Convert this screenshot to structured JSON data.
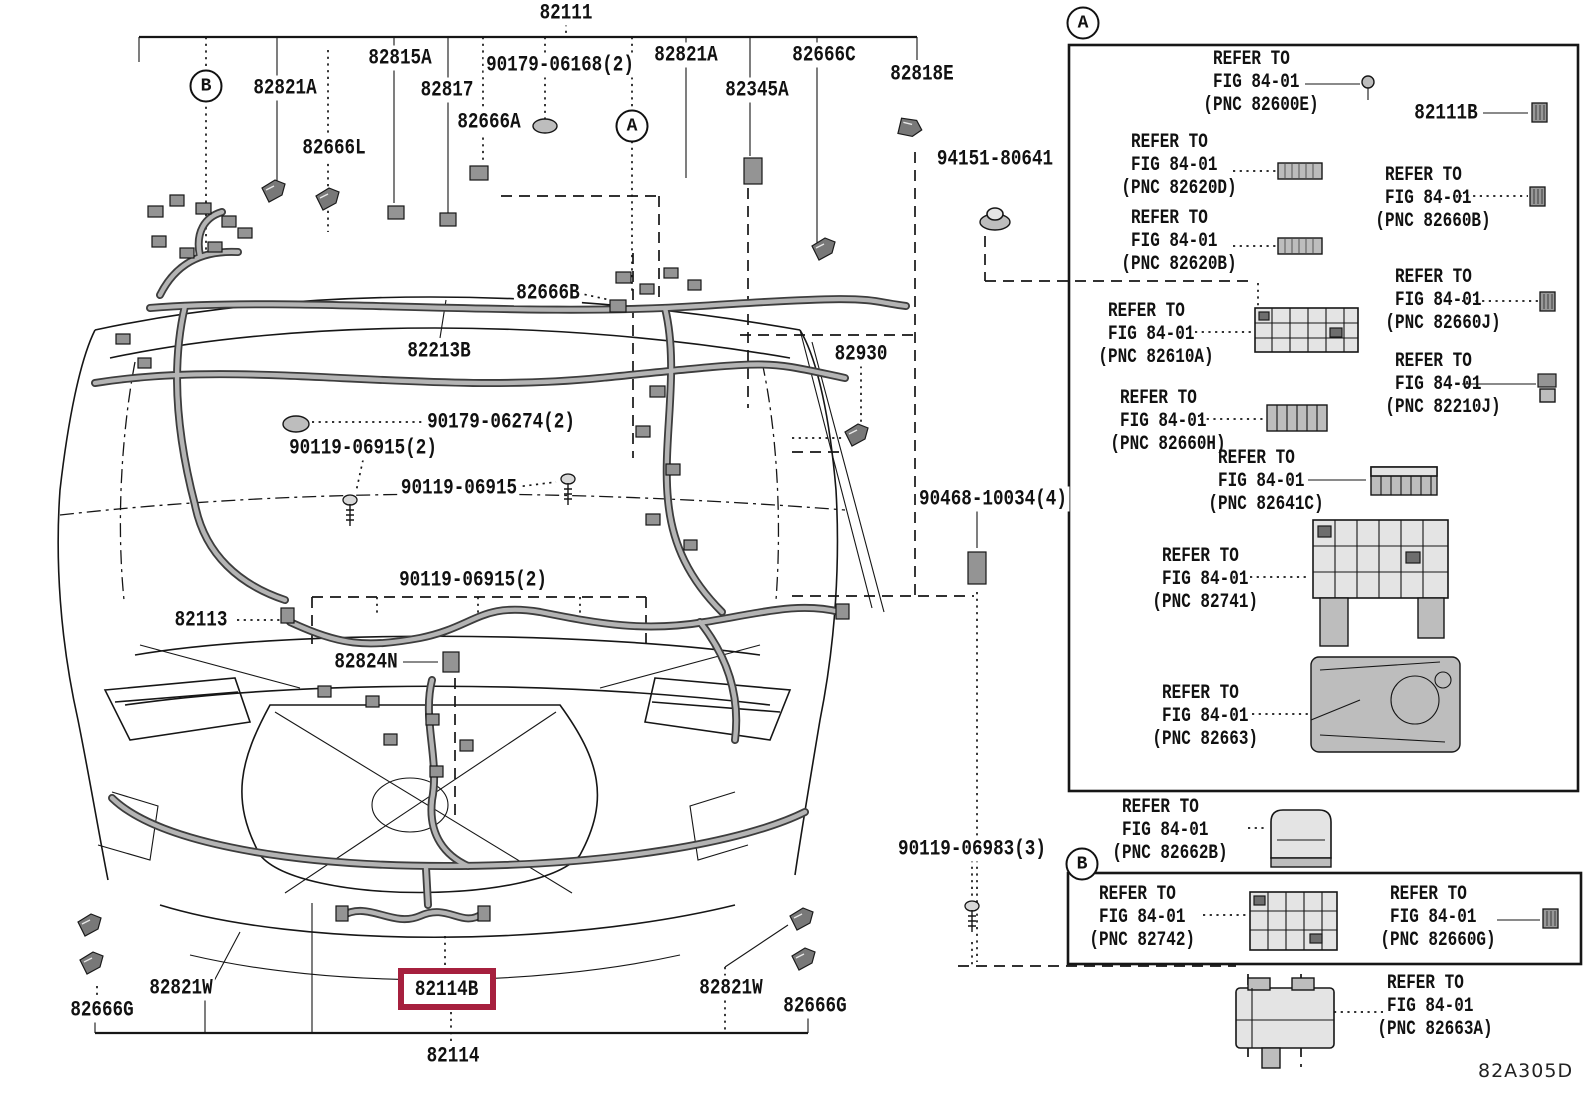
{
  "diagram_code": "82A305D",
  "highlight_color": "#a6203e",
  "markers": {
    "top_b": "B",
    "top_a": "A",
    "panel_a": "A",
    "panel_b": "B"
  },
  "labels": {
    "p82111": "82111",
    "p82821a_l": "82821A",
    "p82815a": "82815A",
    "p82817": "82817",
    "p90179_06168": "90179-06168(2)",
    "p82666a": "82666A",
    "p82666l": "82666L",
    "p82821a_r": "82821A",
    "p82345a": "82345A",
    "p82666c": "82666C",
    "p82818e": "82818E",
    "p94151_80641": "94151-80641",
    "p82666b": "82666B",
    "p82213b": "82213B",
    "p82930": "82930",
    "p90179_06274": "90179-06274(2)",
    "p90119_06915_2a": "90119-06915(2)",
    "p90119_06915": "90119-06915",
    "p90468_10034": "90468-10034(4)",
    "p90119_06915_2b": "90119-06915(2)",
    "p82113": "82113",
    "p82824n": "82824N",
    "p90119_06983": "90119-06983(3)",
    "p82821w_l": "82821W",
    "p82666g_l": "82666G",
    "p82114b": "82114B",
    "p82821w_r": "82821W",
    "p82666g_r": "82666G",
    "p82114": "82114",
    "p82111b": "82111B"
  },
  "panel_a": [
    {
      "refer": "REFER TO",
      "fig": "FIG 84-01",
      "pnc": "(PNC 82600E)"
    },
    {
      "refer": "REFER TO",
      "fig": "FIG 84-01",
      "pnc": "(PNC 82620D)"
    },
    {
      "refer": "REFER TO",
      "fig": "FIG 84-01",
      "pnc": "(PNC 82660B)"
    },
    {
      "refer": "REFER TO",
      "fig": "FIG 84-01",
      "pnc": "(PNC 82620B)"
    },
    {
      "refer": "REFER TO",
      "fig": "FIG 84-01",
      "pnc": "(PNC 82610A)"
    },
    {
      "refer": "REFER TO",
      "fig": "FIG 84-01",
      "pnc": "(PNC 82660J)"
    },
    {
      "refer": "REFER TO",
      "fig": "FIG 84-01",
      "pnc": "(PNC 82660H)"
    },
    {
      "refer": "REFER TO",
      "fig": "FIG 84-01",
      "pnc": "(PNC 82210J)"
    },
    {
      "refer": "REFER TO",
      "fig": "FIG 84-01",
      "pnc": "(PNC 82641C)"
    },
    {
      "refer": "REFER TO",
      "fig": "FIG 84-01",
      "pnc": "(PNC 82741)"
    },
    {
      "refer": "REFER TO",
      "fig": "FIG 84-01",
      "pnc": "(PNC 82663)"
    }
  ],
  "below_panel_a": [
    {
      "refer": "REFER TO",
      "fig": "FIG 84-01",
      "pnc": "(PNC 82662B)"
    }
  ],
  "panel_b": [
    {
      "refer": "REFER TO",
      "fig": "FIG 84-01",
      "pnc": "(PNC 82742)"
    },
    {
      "refer": "REFER TO",
      "fig": "FIG 84-01",
      "pnc": "(PNC 82660G)"
    }
  ],
  "below_panel_b": [
    {
      "refer": "REFER TO",
      "fig": "FIG 84-01",
      "pnc": "(PNC 82663A)"
    }
  ]
}
